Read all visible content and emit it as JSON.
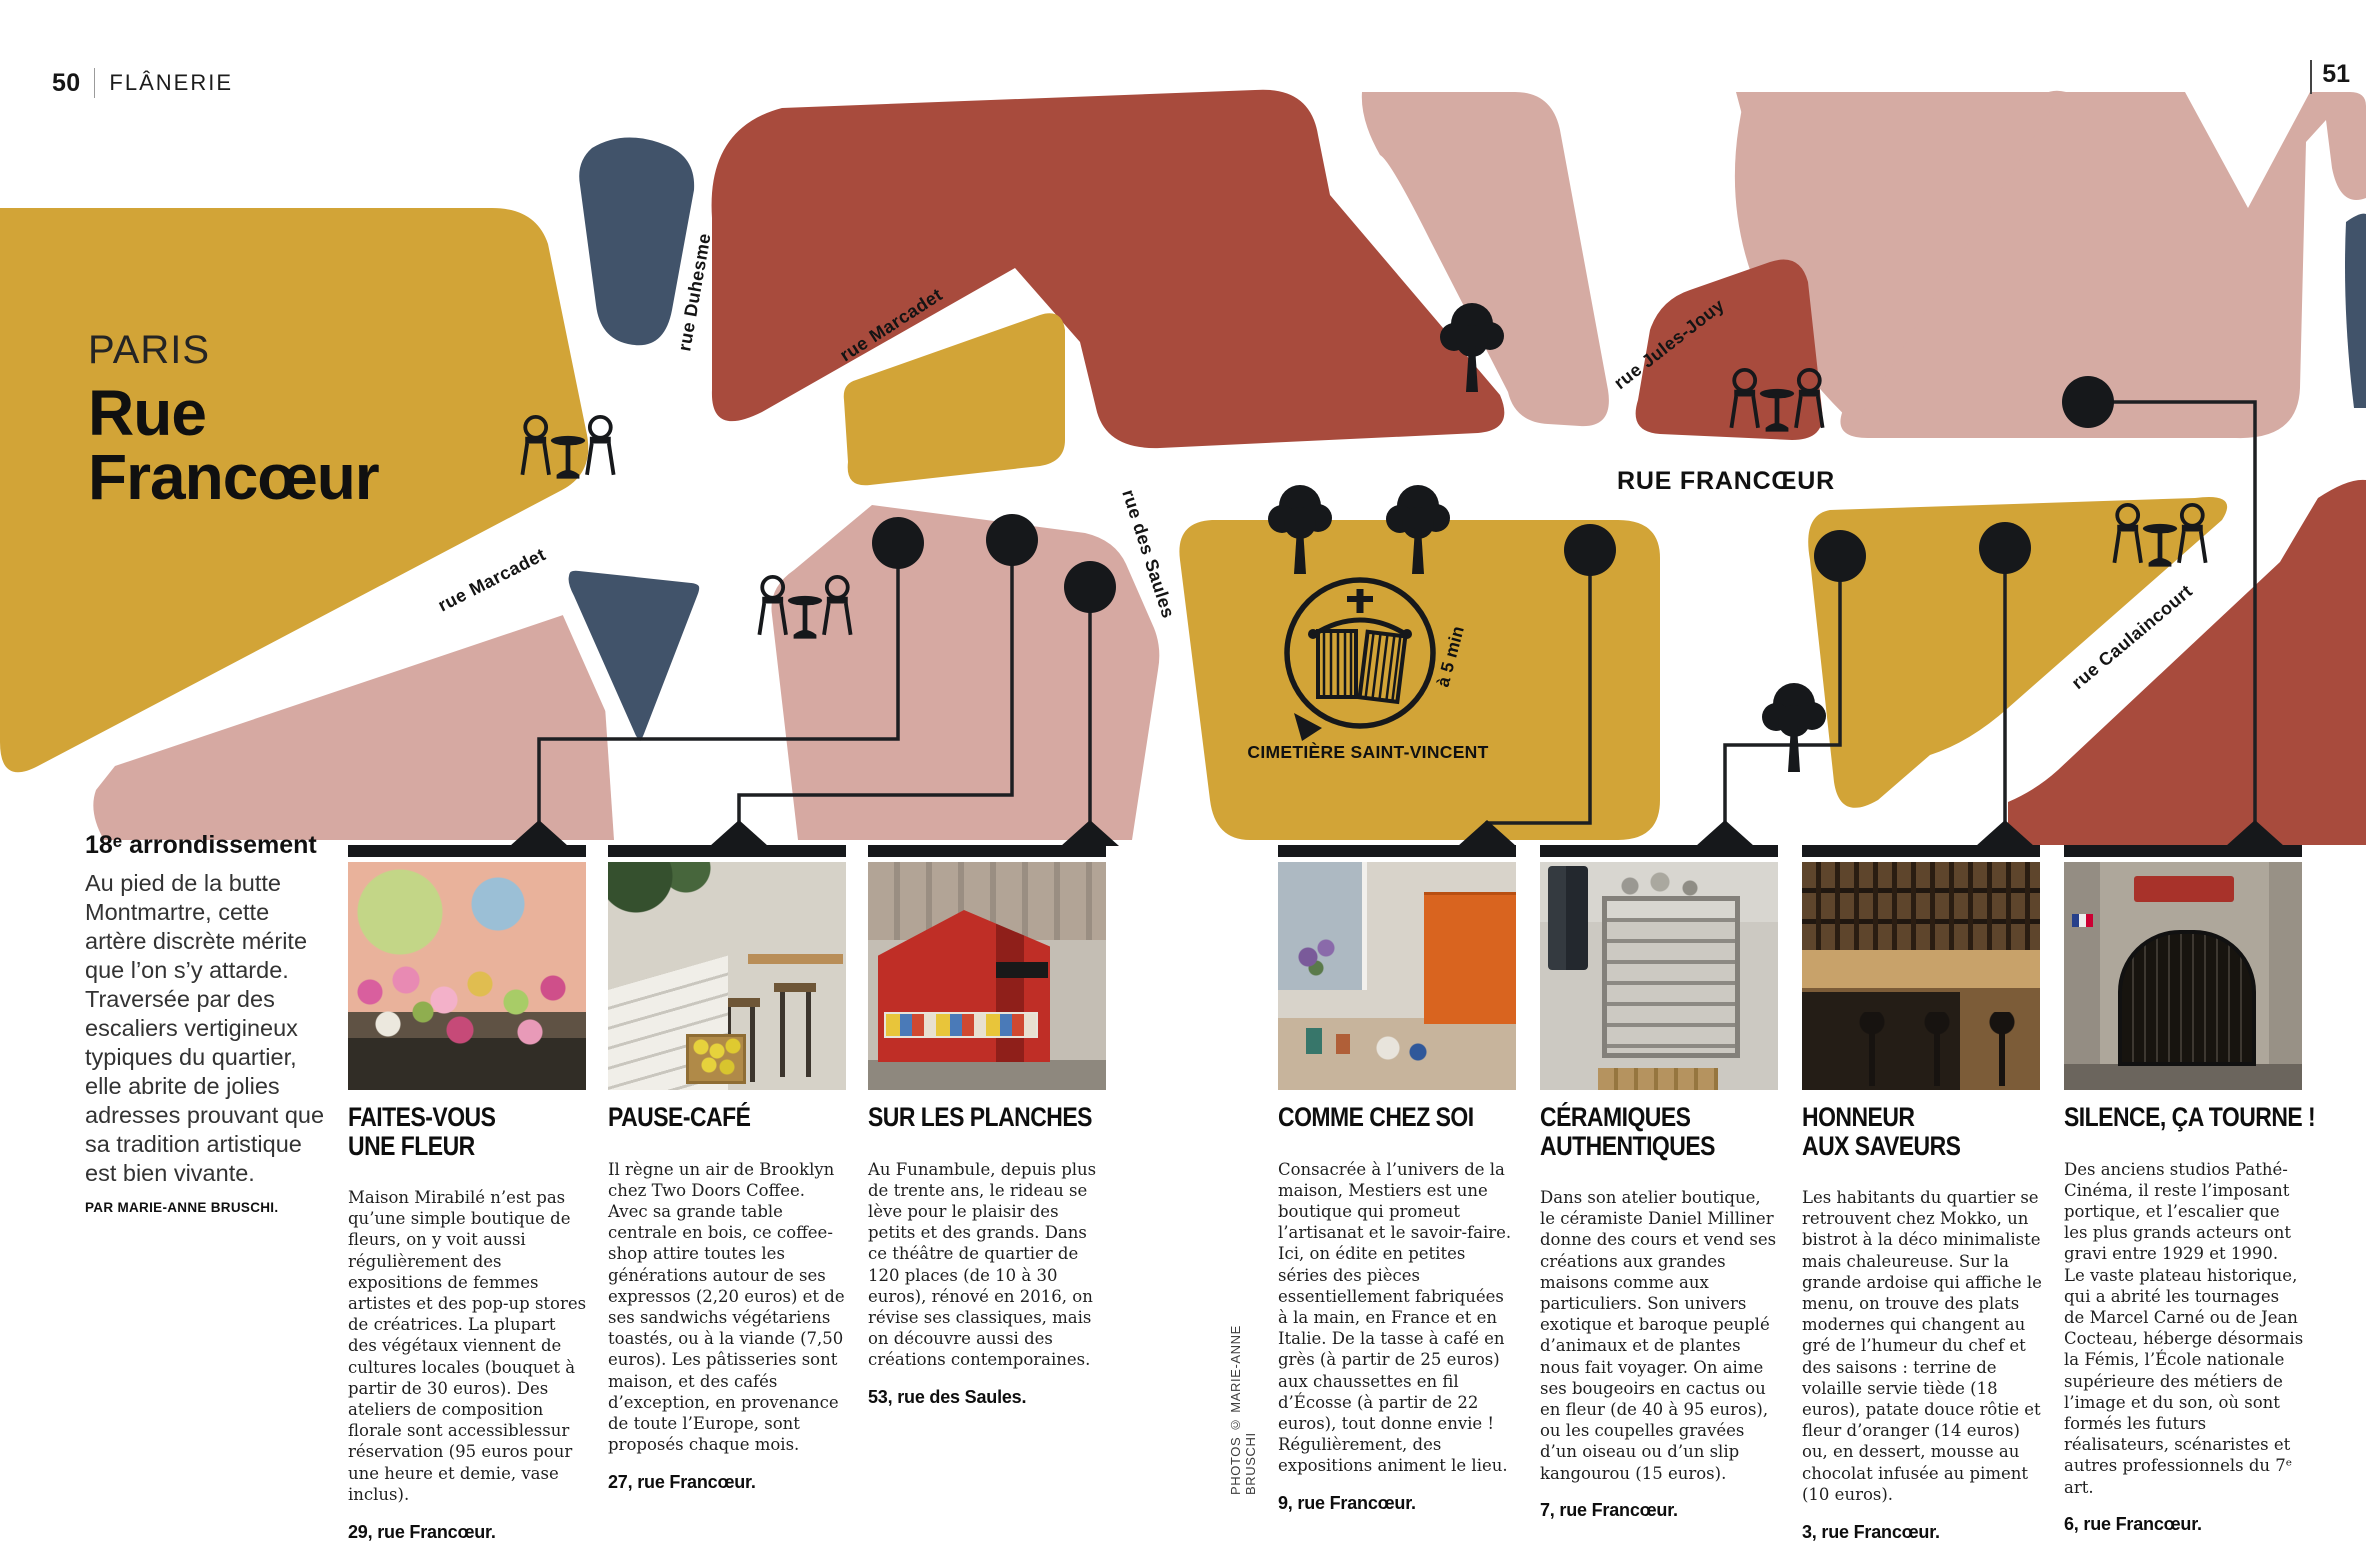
{
  "page": {
    "number_left": "50",
    "section": "FLÂNERIE",
    "number_right": "51"
  },
  "title": {
    "city": "PARIS",
    "street": "Rue Francœur"
  },
  "intro": {
    "heading": "18ᵉ arrondissement",
    "body": "Au pied de la butte Montmartre, cette artère discrète mérite que l’on s’y attarde. Traversée par des escaliers vertigineux typiques du quartier, elle abrite de jolies adresses prouvant que sa tradition artistique est bien vivante.",
    "byline": "PAR MARIE-ANNE BRUSCHI."
  },
  "map": {
    "streets": {
      "duhesme": "rue Duhesme",
      "marcadet_upper": "rue Marcadet",
      "marcadet_lower": "rue Marcadet",
      "saules": "rue des Saules",
      "jules_jouy": "rue Jules-Jouy",
      "francoeur": "RUE FRANCŒUR",
      "caulaincourt": "rue Caulaincourt"
    },
    "cemetery_label": "CIMETIÈRE SAINT-VINCENT",
    "walk_time": "à 5 min",
    "colors": {
      "gold": "#D2A437",
      "brick": "#A84B3D",
      "pink": "#D6A9A2",
      "pale_pink": "#D5ABA3",
      "slate": "#41536A",
      "ink": "#16181B"
    }
  },
  "photo_credit": "PHOTOS © MARIE-ANNE BRUSCHI",
  "listings": [
    {
      "title": "FAITES-VOUS\nUNE FLEUR",
      "body": "Maison Mirabilé n’est pas qu’une simple boutique de fleurs, on y voit aussi régulièrement des expositions de femmes artistes et des pop-up stores de créatrices. La plupart des végétaux viennent de cultures locales (bouquet à partir de 30 euros). Des ateliers de composition florale sont accessiblessur réservation (95 euros pour une heure et demie, vase inclus).",
      "address": "29, rue Francœur."
    },
    {
      "title": "PAUSE-CAFÉ",
      "body": "Il règne un air de Brooklyn chez Two Doors Coffee. Avec sa grande table centrale en bois, ce coffee-shop attire toutes les générations autour de ses expressos (2,20 euros) et de ses sandwichs végétariens toastés, ou à la viande (7,50 euros). Les pâtisseries sont maison, et des cafés d’exception, en provenance de toute l’Europe, sont proposés chaque mois.",
      "address": "27, rue Francœur."
    },
    {
      "title": "SUR LES PLANCHES",
      "body": "Au Funambule, depuis plus de trente ans, le rideau se lève pour le plaisir des petits et des grands. Dans ce théâtre de quartier de 120 places (de 10 à 30 euros), rénové en 2016, on révise ses classiques, mais on découvre aussi des créations contemporaines.",
      "address": "53, rue des Saules."
    },
    {
      "title": "COMME CHEZ SOI",
      "body": "Consacrée à l’univers de la maison, Mestiers est une boutique qui promeut l’artisanat et le savoir-faire. Ici, on édite en petites séries des pièces essentiellement fabriquées à la main, en France et en Italie. De la tasse à café en grès (à partir de 25 euros) aux chaussettes en fil d’Écosse (à partir de 22 euros), tout donne envie ! Régulièrement, des expositions animent le lieu.",
      "address": "9, rue Francœur."
    },
    {
      "title": "CÉRAMIQUES\nAUTHENTIQUES",
      "body": "Dans son atelier boutique, le céramiste Daniel Milliner donne des cours et vend ses créations aux grandes maisons comme aux particuliers. Son univers exotique et baroque peuplé d’animaux et de plantes nous fait voyager. On aime ses bougeoirs en cactus ou en fleur (de 40 à 95 euros), ou les coupelles gravées d’un oiseau ou d’un slip kangourou (15 euros).",
      "address": "7, rue Francœur."
    },
    {
      "title": "HONNEUR\nAUX SAVEURS",
      "body": "Les habitants du quartier se retrouvent chez Mokko, un bistrot à la déco minimaliste mais chaleureuse. Sur la grande ardoise qui affiche le menu, on trouve des plats modernes qui changent au gré de l’humeur du chef et des saisons : terrine de volaille servie tiède (18 euros), patate douce rôtie et fleur d’oranger (14 euros) ou, en dessert, mousse au chocolat infusée au piment (10 euros).",
      "address": "3, rue Francœur."
    },
    {
      "title": "SILENCE, ÇA TOURNE !",
      "body": "Des anciens studios Pathé-Cinéma, il reste l’imposant portique, et l’escalier que les plus grands acteurs ont gravi entre 1929 et 1990. Le vaste plateau historique, qui a abrité les tournages de Marcel Carné ou de Jean Cocteau, héberge désormais la Fémis, l’École nationale supérieure des métiers de l’image et du son, où sont formés les futurs réalisateurs, scénaristes et autres professionnels du 7ᵉ art.",
      "address": "6, rue Francœur."
    }
  ]
}
